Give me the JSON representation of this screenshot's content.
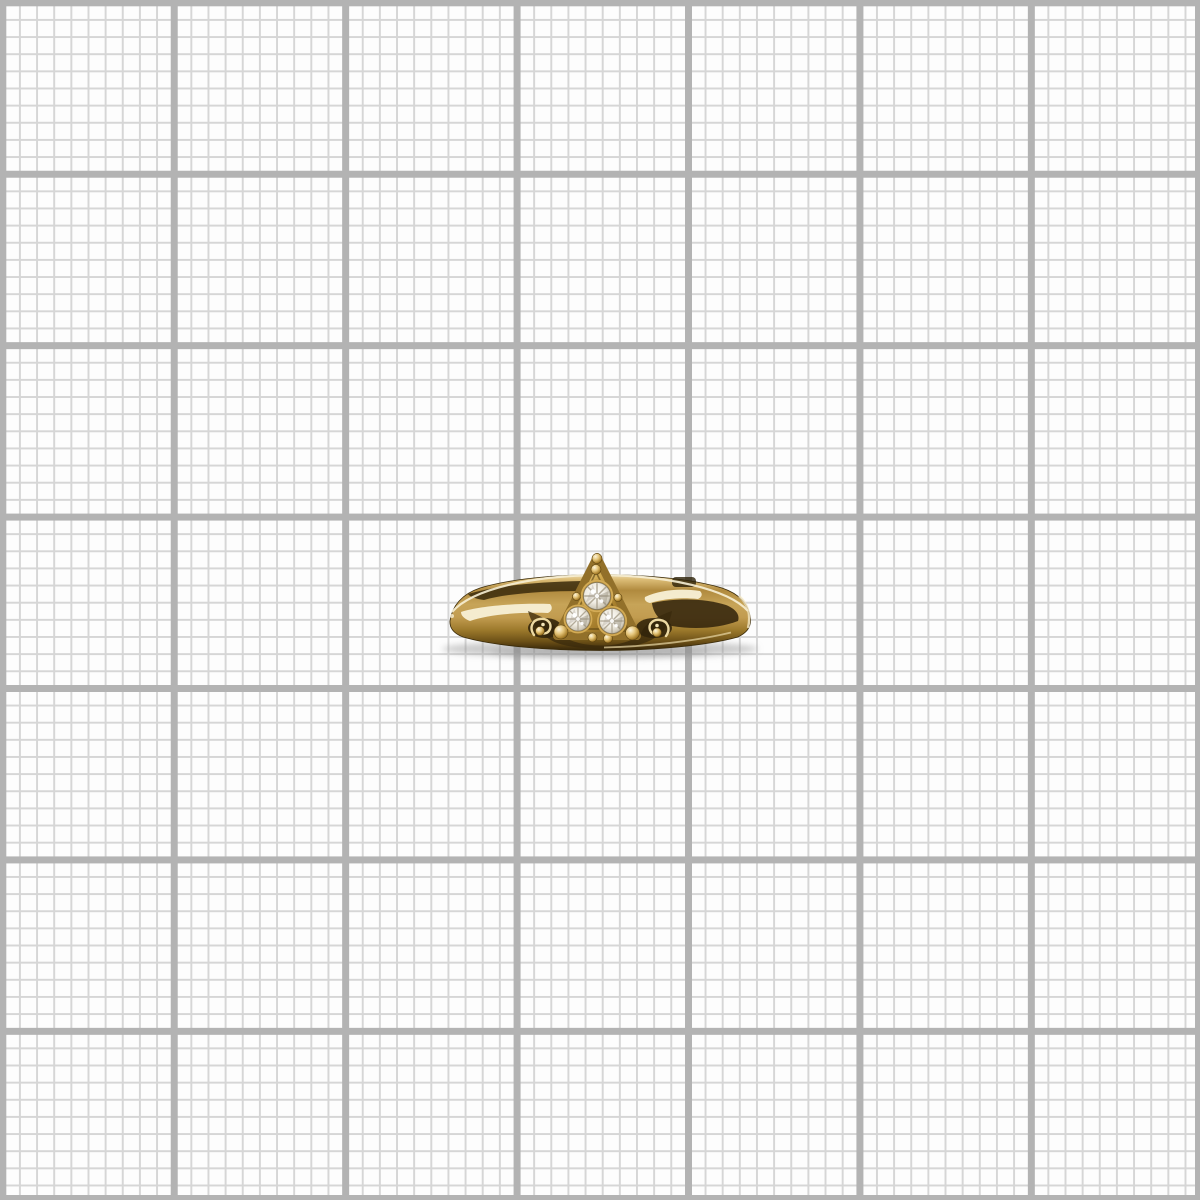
{
  "scene": {
    "description": "Close-up product photograph of a polished yellow-gold ring resting on white graph paper, band seen nearly edge-on with a triangular crown pointing upward",
    "image_width_px": 1200,
    "image_height_px": 1200,
    "text_content": "none - the image contains no visible text"
  },
  "graph_paper": {
    "paper_color": "#fdfdfd",
    "minor_line_color": "#d6d6d6",
    "major_line_color": "#b3b3b3",
    "minor_cell_size_px": 17.1429,
    "major_cell_size_px": 171.4286,
    "minor_line_width_px": 2,
    "major_line_width_px": 7,
    "major_cells_across": 7,
    "minor_cells_per_major": 10,
    "edge_frame_width_px": 5
  },
  "ring": {
    "material": "polished yellow gold with mirror-like reflections",
    "orientation": "band horizontal, viewed edge-on, crystal setting facing up",
    "bounding_box": {
      "left": 449,
      "top": 556,
      "right": 751,
      "bottom": 654
    },
    "band": {
      "left_tip_x": 450,
      "right_tip_x": 750,
      "top_edge_y": 575,
      "bottom_edge_y": 650
    },
    "setting": {
      "shape": "triangle with rounded beaded corners",
      "apex": {
        "x": 597,
        "y": 557
      },
      "base_y": 637,
      "side_ornament": "S-scroll filigree curls on both shoulders",
      "beads": [
        {
          "cx": 597,
          "cy": 558.5,
          "r": 5
        },
        {
          "cx": 596,
          "cy": 569.5,
          "r": 5
        },
        {
          "cx": 561,
          "cy": 632,
          "r": 7
        },
        {
          "cx": 632.5,
          "cy": 633,
          "r": 7
        },
        {
          "cx": 576.5,
          "cy": 596.5,
          "r": 4
        },
        {
          "cx": 618,
          "cy": 597.5,
          "r": 4
        },
        {
          "cx": 592.5,
          "cy": 637.5,
          "r": 4.5
        },
        {
          "cx": 608,
          "cy": 638.5,
          "r": 4.5
        },
        {
          "cx": 540,
          "cy": 631,
          "r": 4.5
        },
        {
          "cx": 657,
          "cy": 632.5,
          "r": 4.5
        }
      ]
    },
    "crystals": {
      "count": 3,
      "cut": "small round faceted colorless stones",
      "positions": [
        {
          "cx": 597,
          "cy": 596,
          "r": 13.5
        },
        {
          "cx": 578,
          "cy": 619,
          "r": 12
        },
        {
          "cx": 612,
          "cy": 621,
          "r": 12.5
        }
      ]
    },
    "palette": {
      "gold_highlight": "#f6ecce",
      "gold_light": "#e2c47e",
      "gold_mid": "#b78f3e",
      "gold_dark": "#8a671f",
      "gold_deep": "#45330c",
      "gold_shadow": "#2c1f07",
      "crystal_white": "#ffffff",
      "crystal_light": "#eceade",
      "crystal_facet": "#a89f8c",
      "crystal_dark": "#7e7667"
    },
    "shadow_color": "#8a8a8a"
  }
}
